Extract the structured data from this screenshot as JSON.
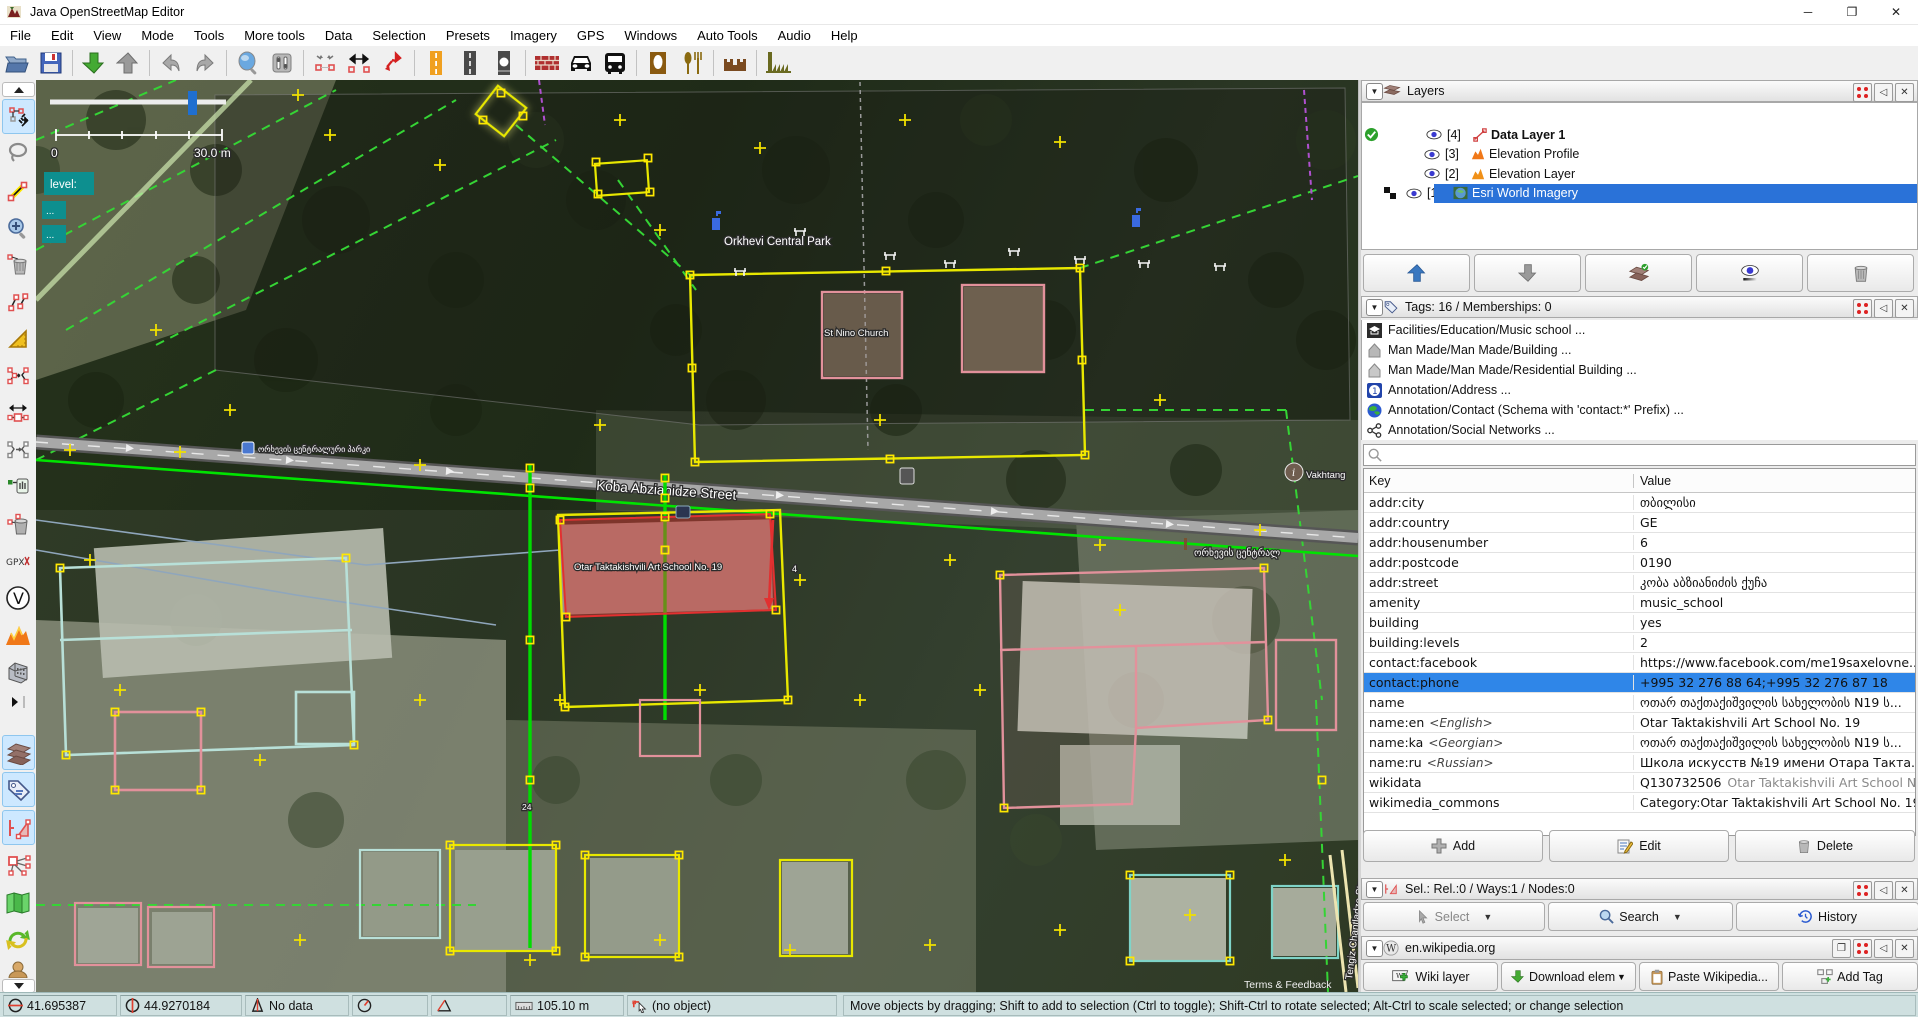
{
  "window": {
    "title": "Java OpenStreetMap Editor",
    "minimize": "─",
    "maximize": "❐",
    "close": "✕"
  },
  "menu": {
    "items": [
      "File",
      "Edit",
      "View",
      "Mode",
      "Tools",
      "More tools",
      "Data",
      "Selection",
      "Presets",
      "Imagery",
      "GPS",
      "Windows",
      "Auto Tools",
      "Audio",
      "Help"
    ]
  },
  "toolbar": {
    "icons": [
      "open",
      "save",
      "download",
      "upload",
      "undo",
      "redo",
      "zoom",
      "preferences",
      "merge-nodes",
      "combine-way",
      "reverse-way",
      "motorway",
      "road",
      "crossing",
      "wall",
      "car",
      "bus",
      "monument",
      "restaurant",
      "castle",
      "works"
    ]
  },
  "left_toolbar": {
    "tools": [
      "collapse",
      "move",
      "lasso",
      "draw",
      "zoom",
      "delete",
      "unglue",
      "angle-ruler",
      "merge-ways",
      "extrude",
      "follow-line",
      "grab-node",
      "delete-node",
      "gpx",
      "validator",
      "elevation",
      "building",
      "expand",
      "layers-dialog",
      "tags-dialog",
      "selection-dialog",
      "relations-dialog",
      "minimap",
      "synchronize",
      "user",
      "more"
    ]
  },
  "map": {
    "scale_zero": "0",
    "scale_label": "30.0 m",
    "level_label": "level:",
    "dots": "...",
    "labels": {
      "park_en": "Orkhevi Central Park",
      "park_ka": "ორხევის ცენტრალ",
      "park_ka_small": "ორხევის ცენტრალური პარკი",
      "church": "St Nino Church",
      "street": "Koba Abzianidze Street",
      "school": "Otar Taktakishvili Art School No. 19",
      "street_side": "Tengiz Chantladze Street",
      "vakhtang": "Vakhtang",
      "terms": "Terms & Feedback",
      "house_a": "4",
      "house_b": "24"
    }
  },
  "layers_panel": {
    "title": "Layers",
    "rows": [
      {
        "num": "[4]",
        "name": "Data Layer 1"
      },
      {
        "num": "[3]",
        "name": "Elevation Profile"
      },
      {
        "num": "[2]",
        "name": "Elevation Layer"
      },
      {
        "num": "[1]",
        "name": "Esri World Imagery"
      }
    ]
  },
  "tags_panel": {
    "title": "Tags: 16 / Memberships: 0",
    "presets": [
      "Facilities/Education/Music school ...",
      "Man Made/Man Made/Building ...",
      "Man Made/Man Made/Residential Building ...",
      "Annotation/Address ...",
      "Annotation/Contact (Schema with 'contact:*' Prefix) ...",
      "Annotation/Social Networks ..."
    ],
    "key_header": "Key",
    "value_header": "Value",
    "rows": [
      {
        "key": "addr:city",
        "value": "თბილისი"
      },
      {
        "key": "addr:country",
        "value": "GE"
      },
      {
        "key": "addr:housenumber",
        "value": "6"
      },
      {
        "key": "addr:postcode",
        "value": "0190"
      },
      {
        "key": "addr:street",
        "value": "კობა აბზიანიძის ქუჩა"
      },
      {
        "key": "amenity",
        "value": "music_school"
      },
      {
        "key": "building",
        "value": "yes"
      },
      {
        "key": "building:levels",
        "value": "2"
      },
      {
        "key": "contact:facebook",
        "value": "https://www.facebook.com/me19saxelovne..."
      },
      {
        "key": "contact:phone",
        "value": "+995 32 276 88 64;+995 32 276 87 18"
      },
      {
        "key": "name",
        "value": "ოთარ თაქთაქიშვილის სახელობის N19 ს..."
      },
      {
        "key": "name:en",
        "lang": "<English>",
        "value": "Otar Taktakishvili Art School No. 19"
      },
      {
        "key": "name:ka",
        "lang": "<Georgian>",
        "value": "ოთარ თაქთაქიშვილის სახელობის N19 ს..."
      },
      {
        "key": "name:ru",
        "lang": "<Russian>",
        "value": "Школа искусств №19 имени Отара Такта..."
      },
      {
        "key": "wikidata",
        "value": "Q130732506",
        "extra": "Otar Taktakishvili Art School No."
      },
      {
        "key": "wikimedia_commons",
        "value": "Category:Otar Taktakishvili Art School No. 19"
      }
    ],
    "buttons": {
      "add": "Add",
      "edit": "Edit",
      "delete": "Delete"
    }
  },
  "selection_panel": {
    "title": "Sel.: Rel.:0 / Ways:1 / Nodes:0",
    "buttons": {
      "select": "Select",
      "search": "Search",
      "history": "History"
    }
  },
  "wikipedia_panel": {
    "title": "en.wikipedia.org",
    "buttons": {
      "wiki_layer": "Wiki layer",
      "download": "Download elem",
      "paste": "Paste Wikipedia...",
      "add_tag": "Add Tag"
    }
  },
  "status_bar": {
    "lat": "41.695387",
    "lon": "44.9270184",
    "nodata": "No data",
    "distance": "105.10 m",
    "object": "(no object)",
    "help": "Move objects by dragging; Shift to add to selection (Ctrl to toggle); Shift-Ctrl to rotate selected; Alt-Ctrl to scale selected; or change selection"
  },
  "colors": {
    "selection_blue": "#2a72d8",
    "row_blue": "#2f86e8",
    "osm_yellow": "#e8e800",
    "osm_green": "#00dc00",
    "selected_red": "#e23030",
    "teal_label": "#0d8f8f"
  }
}
